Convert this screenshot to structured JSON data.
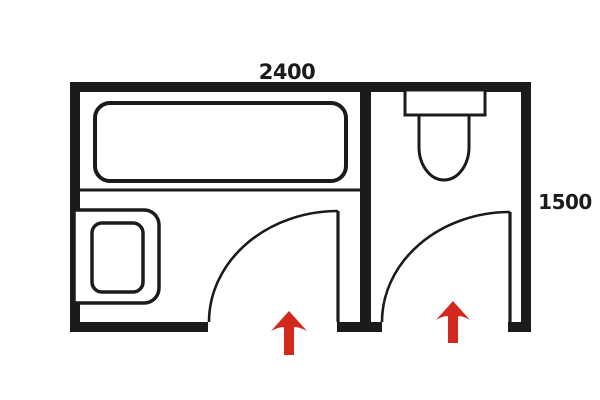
{
  "figure": {
    "kind": "floor-plan",
    "subject": "two-compartment bathroom layout, top-down view"
  },
  "colors": {
    "ink": "#1b1b1b",
    "accent": "#d2281e",
    "bg": "#ffffff",
    "fixture_fill": "#ffffff"
  },
  "labels": {
    "top_dimension": "2400",
    "right_dimension": "1500"
  },
  "rooms": [
    {
      "id": "bath-area",
      "position": "left",
      "fixtures": [
        "bathtub",
        "vanity-with-basin"
      ],
      "door": "quarter-swing-door",
      "entrance_marker": "red-up-arrow"
    },
    {
      "id": "toilet-room",
      "position": "right",
      "fixtures": [
        "toilet"
      ],
      "door": "quarter-swing-door",
      "entrance_marker": "red-up-arrow"
    }
  ],
  "icons": {
    "bathtub": "bathtub-plan-icon",
    "vanity": "washbasin-vanity-plan-icon",
    "toilet": "toilet-plan-icon",
    "door": "door-swing-arc-icon",
    "entrance": "entrance-arrow-icon"
  }
}
